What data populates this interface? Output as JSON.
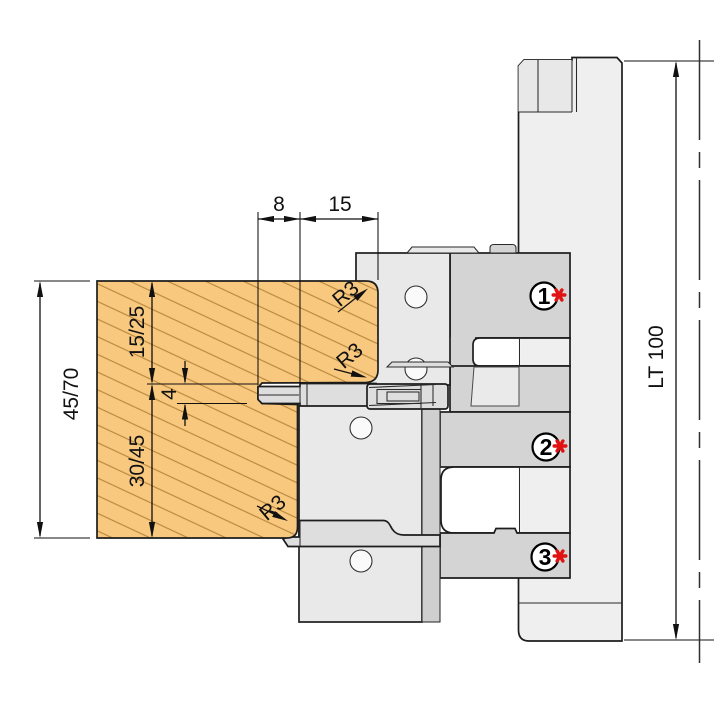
{
  "diagram": {
    "title": "profile-cutter-head-cross-section",
    "dimensions": {
      "groove_depth": "8",
      "tongue_length": "15",
      "upper_section": "15/25",
      "groove_width": "4",
      "lower_section": "30/45",
      "total_thickness": "45/70",
      "tool_length": "LT 100",
      "radius_top": "R3",
      "radius_middle": "R3",
      "radius_bottom": "R3"
    },
    "markers": [
      {
        "label": "1"
      },
      {
        "label": "2"
      },
      {
        "label": "3"
      }
    ],
    "colors": {
      "wood": "#f7c87e",
      "wood_hatch": "#b9873e",
      "hub": "#d4d4d4",
      "plate": "#e9e9e9",
      "knife": "#dedede",
      "strip": "#cfcfcf",
      "pocket": "#eaeaea",
      "spindle": "#efefef",
      "spindle_block": "#e8e8e8",
      "hole": "#fafafa",
      "white": "#ffffff",
      "marker_red": "#e11212"
    }
  }
}
